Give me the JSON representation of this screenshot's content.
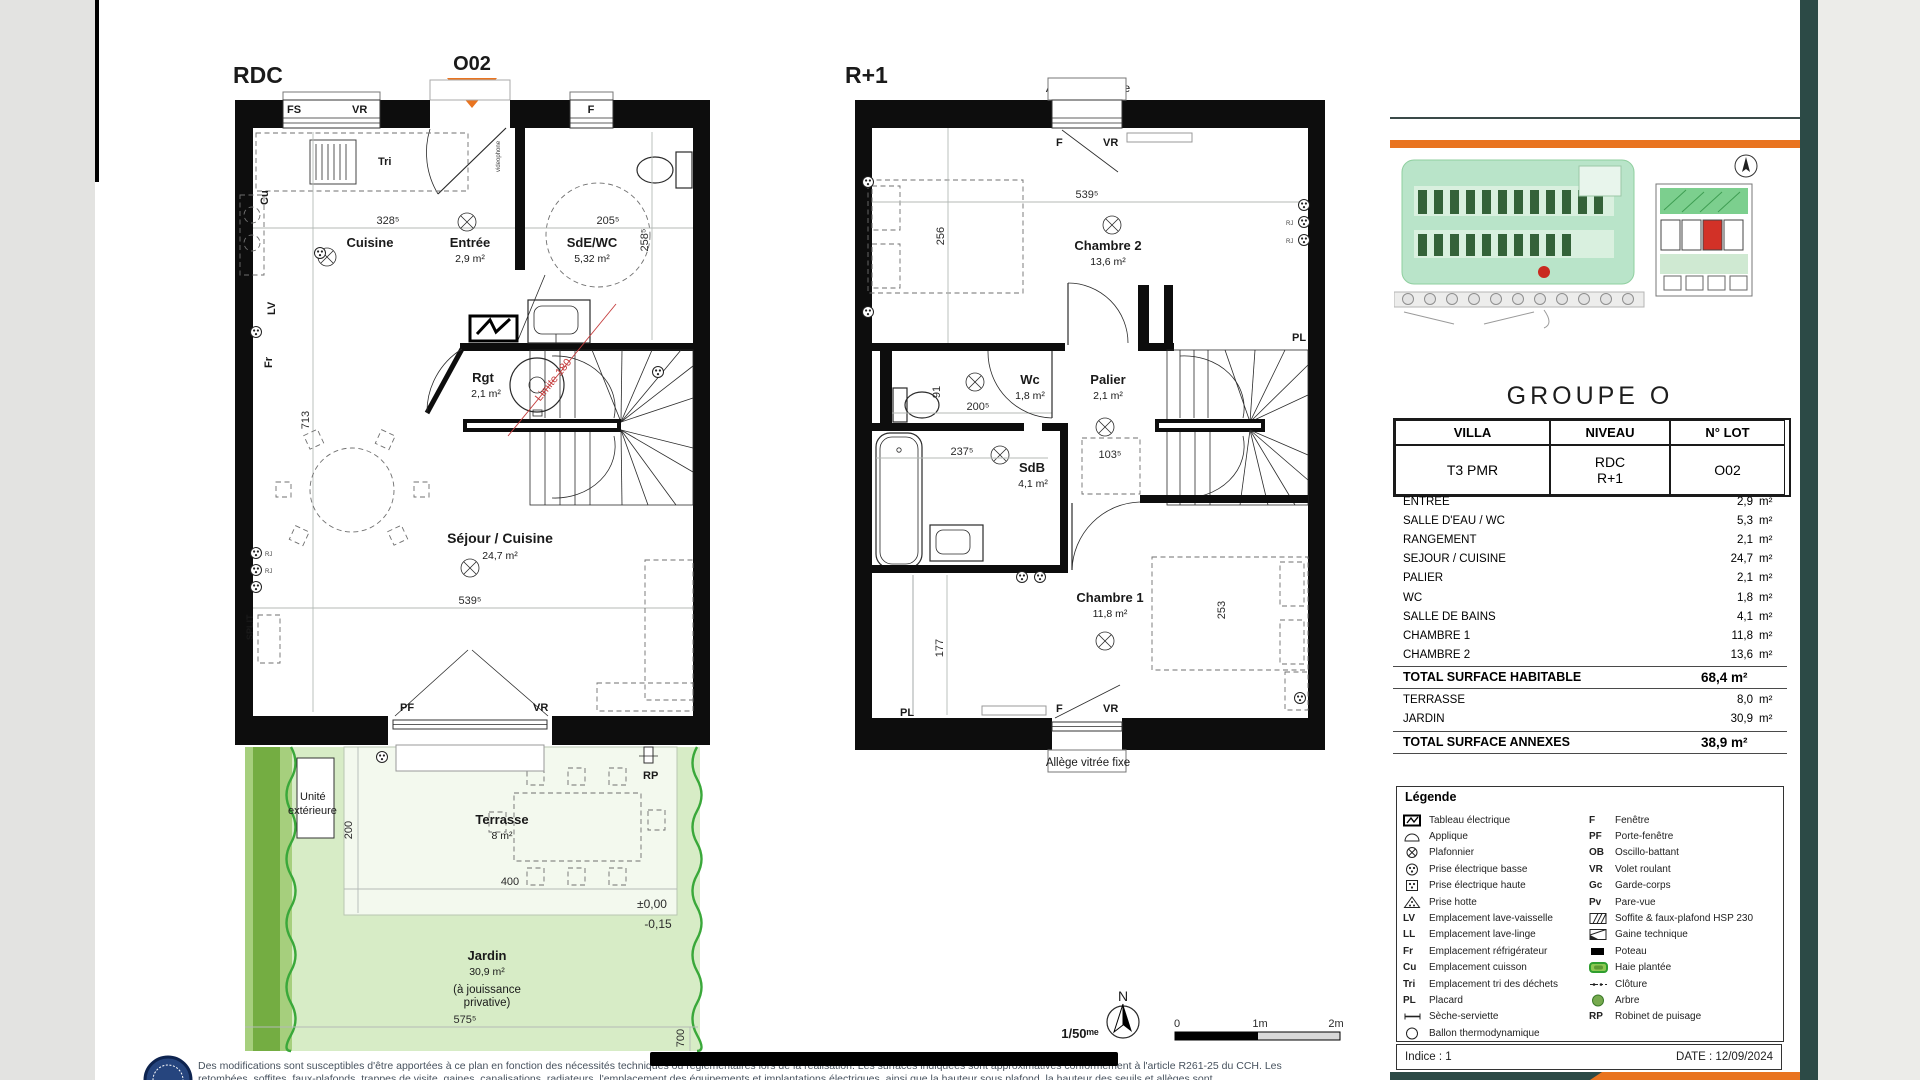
{
  "rdc": {
    "title": "RDC",
    "lot_marker": "O02",
    "window_fs": "FS",
    "window_vr": "VR",
    "window_f": "F",
    "tri": "Tri",
    "cu": "Cu",
    "lv": "LV",
    "fr": "Fr",
    "split": "SPLIT",
    "rj": "RJ",
    "videophone": "videophone",
    "cuisine": "Cuisine",
    "entree": "Entrée",
    "entree_area": "2,9 m²",
    "sde": "SdE/WC",
    "sde_area": "5,32 m²",
    "rgt": "Rgt",
    "rgt_area": "2,1 m²",
    "sejour": "Séjour / Cuisine",
    "sejour_area": "24,7 m²",
    "limite": "Limite 180",
    "pf": "PF",
    "vr_bottom": "VR",
    "d328": "328⁵",
    "d205": "205⁵",
    "d258": "258⁵",
    "d713": "713",
    "d539": "539⁵"
  },
  "garden": {
    "unite_1": "Unité",
    "unite_2": "extérieure",
    "terrasse": "Terrasse",
    "terrasse_area": "8 m²",
    "d200": "200",
    "d400": "400",
    "d575": "575⁵",
    "d700": "700",
    "rp": "RP",
    "level_zero": "±0,00",
    "level_minus": "-0,15",
    "jardin": "Jardin",
    "jardin_area": "30,9 m²",
    "jouissance_1": "(à jouissance",
    "jouissance_2": "privative)"
  },
  "r1": {
    "title": "R+1",
    "allege_top": "Allège vitrée fixe",
    "allege_bottom": "Allège vitrée fixe",
    "f_top": "F",
    "vr_top": "VR",
    "f_bottom": "F",
    "vr_bottom": "VR",
    "chambre2": "Chambre 2",
    "chambre2_area": "13,6 m²",
    "wc": "Wc",
    "wc_area": "1,8 m²",
    "palier": "Palier",
    "palier_area": "2,1 m²",
    "sdb": "SdB",
    "sdb_area": "4,1 m²",
    "chambre1": "Chambre 1",
    "chambre1_area": "11,8 m²",
    "pl_right": "PL",
    "pl_bottom": "PL",
    "rj": "RJ",
    "d539": "539⁵",
    "d256": "256",
    "d200": "200⁵",
    "d237": "237⁵",
    "d103": "103⁵",
    "d91": "91",
    "d177": "177",
    "d253": "253"
  },
  "scalebar": {
    "ratio": "1/50ᵐᵉ",
    "north": "N",
    "t0": "0",
    "t1": "1m",
    "t2": "2m"
  },
  "panel": {
    "group_title": "GROUPE O",
    "info": {
      "h_villa": "VILLA",
      "h_niveau": "NIVEAU",
      "h_lot": "N° LOT",
      "villa": "T3 PMR",
      "niveau_l1": "RDC",
      "niveau_l2": "R+1",
      "lot": "O02"
    },
    "surfaces": [
      {
        "label": "ENTREE",
        "value": "2,9",
        "unit": "m²"
      },
      {
        "label": "SALLE D'EAU / WC",
        "value": "5,3",
        "unit": "m²"
      },
      {
        "label": "RANGEMENT",
        "value": "2,1",
        "unit": "m²"
      },
      {
        "label": "SEJOUR / CUISINE",
        "value": "24,7",
        "unit": "m²"
      },
      {
        "label": "PALIER",
        "value": "2,1",
        "unit": "m²"
      },
      {
        "label": "WC",
        "value": "1,8",
        "unit": "m²"
      },
      {
        "label": "SALLE DE BAINS",
        "value": "4,1",
        "unit": "m²"
      },
      {
        "label": "CHAMBRE 1",
        "value": "11,8",
        "unit": "m²"
      },
      {
        "label": "CHAMBRE 2",
        "value": "13,6",
        "unit": "m²"
      }
    ],
    "total_habitable": {
      "label": "TOTAL SURFACE HABITABLE",
      "value": "68,4 m²"
    },
    "annexes": [
      {
        "label": "TERRASSE",
        "value": "8,0",
        "unit": "m²"
      },
      {
        "label": "JARDIN",
        "value": "30,9",
        "unit": "m²"
      }
    ],
    "total_annexes": {
      "label": "TOTAL SURFACE ANNEXES",
      "value": "38,9 m²"
    },
    "legend": {
      "title": "Légende",
      "left": [
        {
          "abbr": "",
          "label": "Tableau électrique"
        },
        {
          "abbr": "",
          "label": "Applique"
        },
        {
          "abbr": "",
          "label": "Plafonnier"
        },
        {
          "abbr": "",
          "label": "Prise électrique basse"
        },
        {
          "abbr": "",
          "label": "Prise électrique haute"
        },
        {
          "abbr": "",
          "label": "Prise hotte"
        },
        {
          "abbr": "LV",
          "label": "Emplacement lave-vaisselle"
        },
        {
          "abbr": "LL",
          "label": "Emplacement lave-linge"
        },
        {
          "abbr": "Fr",
          "label": "Emplacement réfrigérateur"
        },
        {
          "abbr": "Cu",
          "label": "Emplacement cuisson"
        },
        {
          "abbr": "Tri",
          "label": "Emplacement tri des déchets"
        },
        {
          "abbr": "PL",
          "label": "Placard"
        },
        {
          "abbr": "",
          "label": "Sèche-serviette"
        },
        {
          "abbr": "",
          "label": "Ballon thermodynamique"
        }
      ],
      "right": [
        {
          "abbr": "F",
          "label": "Fenêtre"
        },
        {
          "abbr": "PF",
          "label": "Porte-fenêtre"
        },
        {
          "abbr": "OB",
          "label": "Oscillo-battant"
        },
        {
          "abbr": "VR",
          "label": "Volet roulant"
        },
        {
          "abbr": "Gc",
          "label": "Garde-corps"
        },
        {
          "abbr": "Pv",
          "label": "Pare-vue"
        },
        {
          "abbr": "",
          "label": "Soffite & faux-plafond HSP 230"
        },
        {
          "abbr": "",
          "label": "Gaine technique"
        },
        {
          "abbr": "",
          "label": "Poteau"
        },
        {
          "abbr": "",
          "label": "Haie plantée"
        },
        {
          "abbr": "",
          "label": "Clôture"
        },
        {
          "abbr": "",
          "label": "Arbre"
        },
        {
          "abbr": "RP",
          "label": "Robinet de puisage"
        }
      ]
    },
    "indice": "Indice : 1",
    "date": "DATE : 12/09/2024"
  },
  "footer": {
    "line1": "Des modifications sont susceptibles d'être apportées à ce plan en fonction des nécessités techniques ou réglementaires lors de la réalisation. Les surfaces indiquées sont approximatives conformément à l'article R261-25 du CCH.",
    "line2": "Les retombées, soffites, faux-plafonds, trappes de visite, gaines, canalisations, radiateurs, l'emplacement des équipements et implantations électriques, ainsi que la hauteur sous plafond, la hauteur des seuils et allèges sont"
  }
}
